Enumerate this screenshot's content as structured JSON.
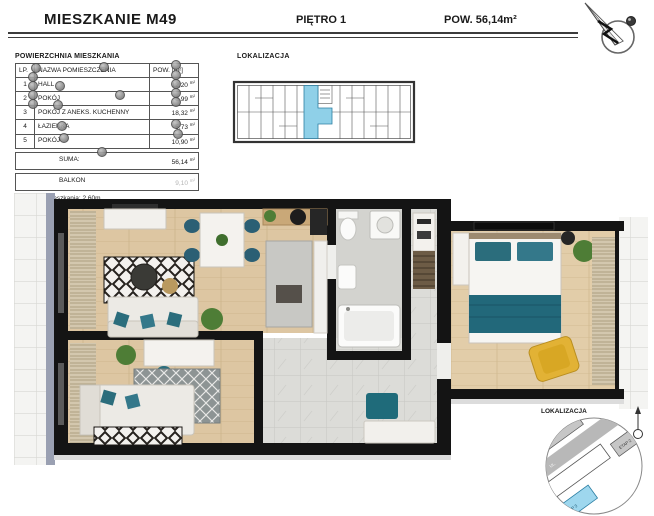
{
  "header": {
    "title": "MIESZKANIE M49",
    "floor": "PIĘTRO 1",
    "area": "POW. 56,14m²"
  },
  "area_table": {
    "title": "POWIERZCHNIA MIESZKANIA",
    "columns": {
      "lp": "LP.",
      "name": "NAZWA POMIESZCZENIA",
      "area": "POW. [m²]"
    },
    "rows": [
      {
        "lp": "1",
        "name": "HALL",
        "area": "12,20",
        "unit": "m²"
      },
      {
        "lp": "2",
        "name": "POKÓJ",
        "area": "8,99",
        "unit": "m²"
      },
      {
        "lp": "3",
        "name": "POKÓJ Z ANEKS. KUCHENNY",
        "area": "18,32",
        "unit": "m²"
      },
      {
        "lp": "4",
        "name": "ŁAZIENKA",
        "area": "5,73",
        "unit": "m²"
      },
      {
        "lp": "5",
        "name": "POKÓJ",
        "area": "10,90",
        "unit": "m²"
      }
    ],
    "summary": {
      "label": "SUMA:",
      "value": "56,14",
      "unit": "m²"
    },
    "balcony": {
      "label": "BALKON",
      "value": "9,10",
      "unit": "m²"
    },
    "height_note": "Wysokość mieszkania: 2,60m"
  },
  "building_plan": {
    "label": "LOKALIZACJA"
  },
  "site_map": {
    "label": "LOKALIZACJA",
    "street_label": "UL.",
    "highlight_building_label": "ETAP 3",
    "gray_building_label": "ETAP 2"
  },
  "icons": {
    "compass": "north-arrow-icon",
    "site_map_north": "north-arrow-small-icon"
  },
  "colors": {
    "accent_teal": "#2b6d7c",
    "wood_floor": "#ddc6a2",
    "tile_gray": "#d9d9d5",
    "highlight_blue": "#8fd0e8",
    "armchair_yellow": "#e2b235",
    "wall_black": "#141414"
  }
}
